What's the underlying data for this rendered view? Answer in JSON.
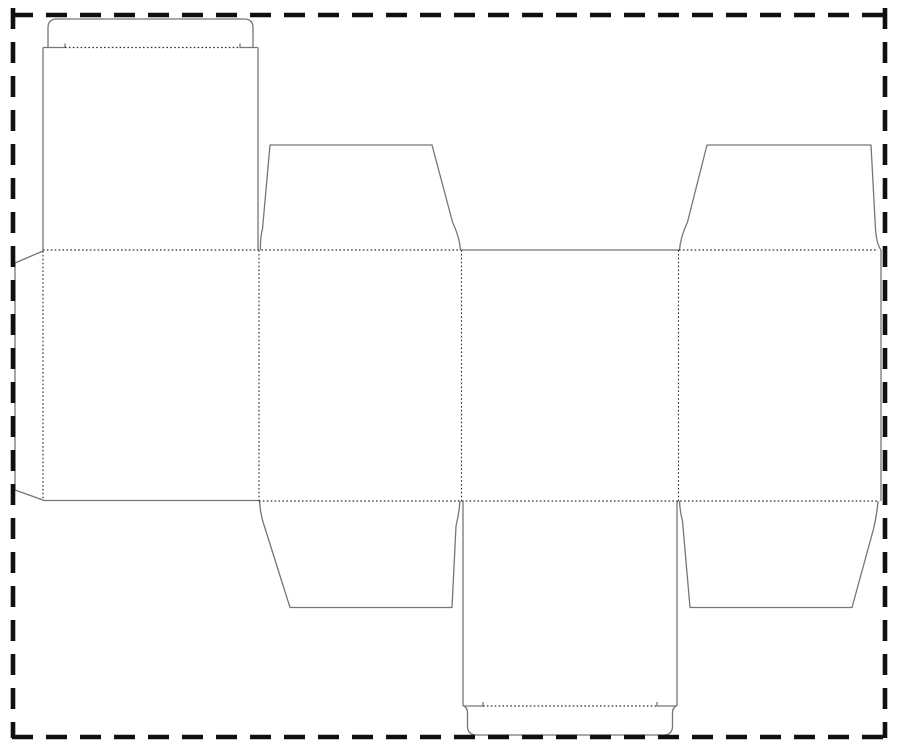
{
  "diagram": {
    "type": "packaging-dieline",
    "description": "Flat die-cut template of a reverse tuck end carton: four body panels in a horizontal band, tuck lid with flap at top left, tuck lid with flap at bottom center, four trapezoid dust flaps, and a glue flap on the left, surrounded by a thick dashed border.",
    "canvas": {
      "width": 900,
      "height": 753,
      "background_color": "#ffffff"
    },
    "styles": {
      "cut": {
        "color": "#767676",
        "width": 1.3,
        "dash": ""
      },
      "fold": {
        "color": "#2e2e2e",
        "width": 1.15,
        "dash": "1.6 2.3"
      },
      "border": {
        "color": "#101010",
        "width": 4.6,
        "dash": "21 13"
      }
    },
    "border_lines": [
      {
        "name": "border-top",
        "d": "M 12,15 L 886,15"
      },
      {
        "name": "border-bottom",
        "d": "M 12,737 L 886,737"
      },
      {
        "name": "border-left",
        "d": "M 13,8 L 13,738"
      },
      {
        "name": "border-right",
        "d": "M 885,8 L 885,738"
      }
    ],
    "cut_paths": [
      {
        "name": "top-tuck-flap",
        "d": "M 48,47.5 L 48,28 Q 48,19 57,19 L 244,19 Q 253,19 253,28 L 253,47.5"
      },
      {
        "name": "top-tuck-shoulder-left",
        "d": "M 43,47.5 L 65,47.5 L 65,43.5"
      },
      {
        "name": "top-tuck-shoulder-right",
        "d": "M 258,47.5 L 240,47.5 L 240,43.5"
      },
      {
        "name": "top-lid-left-edge",
        "d": "M 43,47.5 L 43,250"
      },
      {
        "name": "top-lid-right-edge",
        "d": "M 258,47.5 L 258,250"
      },
      {
        "name": "top-dust-flap-left",
        "d": "M 260.5,250 Q 260,238 262.5,229 L 270,145 L 432,145 L 452.5,222 Q 459.5,237 460.5,250"
      },
      {
        "name": "top-dust-flap-right",
        "d": "M 679.5,250 Q 680.5,237 687.5,222 L 707,145 L 871,145 L 875.5,229 Q 876.5,244 881,250"
      },
      {
        "name": "panel4-right-edge",
        "d": "M 881,250 L 881,501"
      },
      {
        "name": "band-top-cut-center",
        "d": "M 461,250 L 679,250"
      },
      {
        "name": "glue-flap",
        "d": "M 43,251 L 15,263 L 15,490 L 43,500"
      },
      {
        "name": "panel1-bottom-edge",
        "d": "M 43,500.5 L 259,500.5"
      },
      {
        "name": "bottom-dust-flap-left",
        "d": "M 259.5,501 Q 260.5,515 264,525 L 290,607.5 L 452,607.5 L 456,526 Q 459,514 460,501"
      },
      {
        "name": "bottom-dust-flap-right",
        "d": "M 679.5,501 Q 680,512 682.5,521 L 690,607.5 L 852,607.5 L 873.5,529 Q 877,514 878,501"
      },
      {
        "name": "bottom-lid-left-edge",
        "d": "M 463,501 L 463,706"
      },
      {
        "name": "bottom-lid-right-edge",
        "d": "M 677,501 L 677,706"
      },
      {
        "name": "bottom-tuck-shoulder-left",
        "d": "M 463,706 L 483,706 L 483,702"
      },
      {
        "name": "bottom-tuck-shoulder-right",
        "d": "M 677,706 L 657,706 L 657,702"
      },
      {
        "name": "bottom-tuck-flap",
        "d": "M 464,706 Q 467.5,708 467.5,713 L 467.5,726 Q 467.5,735 476.5,735 L 663.5,735 Q 672.5,735 672.5,726 L 672.5,713 Q 672.5,708 676,706"
      }
    ],
    "fold_paths": [
      {
        "name": "fold-top-band-left",
        "d": "M 43,250 L 461,250"
      },
      {
        "name": "fold-top-band-right",
        "d": "M 679,250 L 878,250"
      },
      {
        "name": "fold-bottom-band",
        "d": "M 259,501 L 878,501"
      },
      {
        "name": "fold-glue-flap",
        "d": "M 43,251 L 43,500"
      },
      {
        "name": "fold-panel1-panel2",
        "d": "M 259,250 L 259,501"
      },
      {
        "name": "fold-panel2-panel3",
        "d": "M 461.5,250 L 461.5,501"
      },
      {
        "name": "fold-panel3-panel4",
        "d": "M 678.5,250 L 678.5,501"
      },
      {
        "name": "fold-top-tuck",
        "d": "M 65,47.5 L 240,47.5"
      },
      {
        "name": "fold-bottom-tuck",
        "d": "M 483,706 L 657,706"
      }
    ]
  }
}
